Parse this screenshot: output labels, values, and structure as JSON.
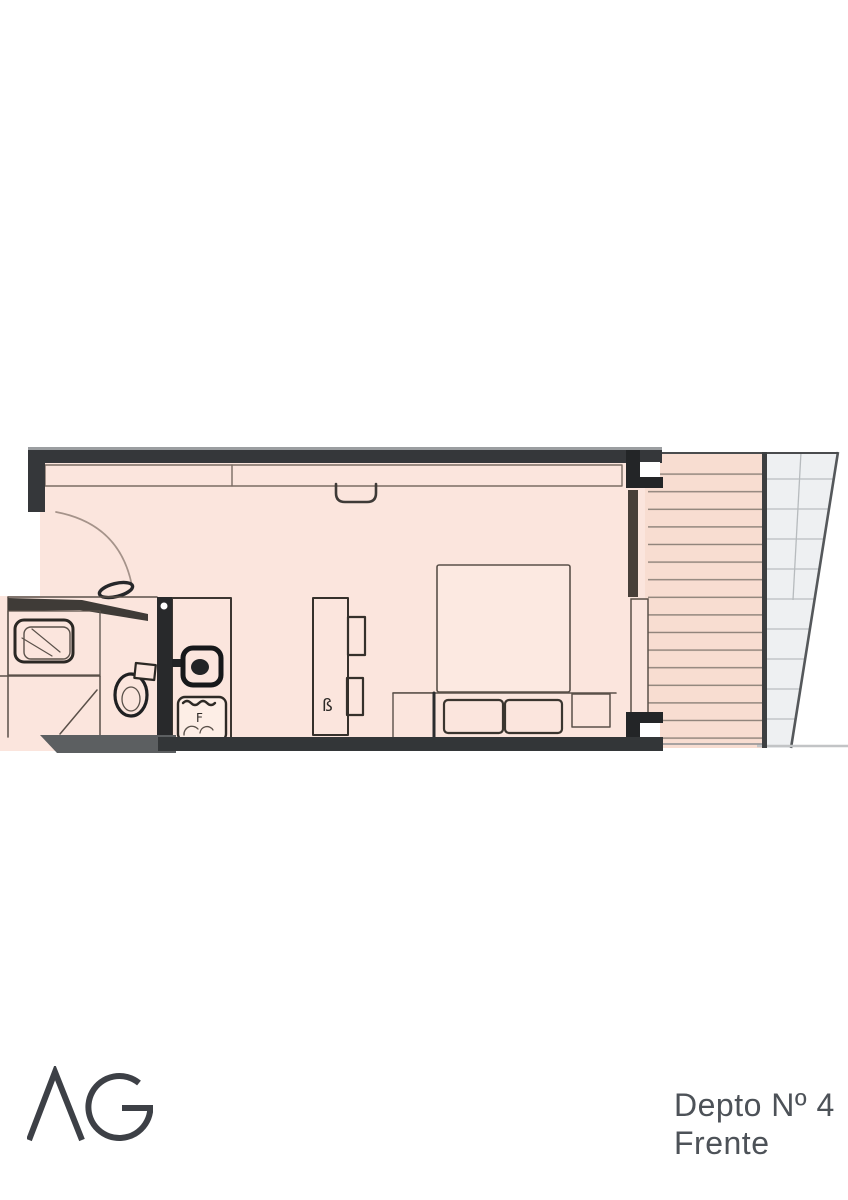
{
  "caption": {
    "line1": "Depto Nº 4",
    "line2": "Frente"
  },
  "logo": {
    "text": "AG"
  },
  "plan": {
    "name": "apartment-floor-plan",
    "desk_glyph": "ß",
    "stove_glyph": "F",
    "features": [
      "entry-door",
      "closet",
      "bathroom-vanity-sink",
      "toilet",
      "shower",
      "kitchen-counter",
      "kitchen-sink",
      "stove",
      "desk",
      "desk-side-units",
      "bed",
      "pillows",
      "nightstands",
      "sliding-glass-door",
      "balcony-deck",
      "stair-glass-area"
    ]
  },
  "colors": {
    "floor": "#fbe5dd",
    "bed_floor": "#fce9e1",
    "balcony_floor": "#f8ddd1",
    "wall": "#35373a",
    "wall_dark": "#232527",
    "band": "#333638",
    "slab": "#5c5f61",
    "glass": "#eef0f2",
    "deck_line": "#8d8178",
    "text": "#4d5258",
    "logo": "#3d4046"
  }
}
